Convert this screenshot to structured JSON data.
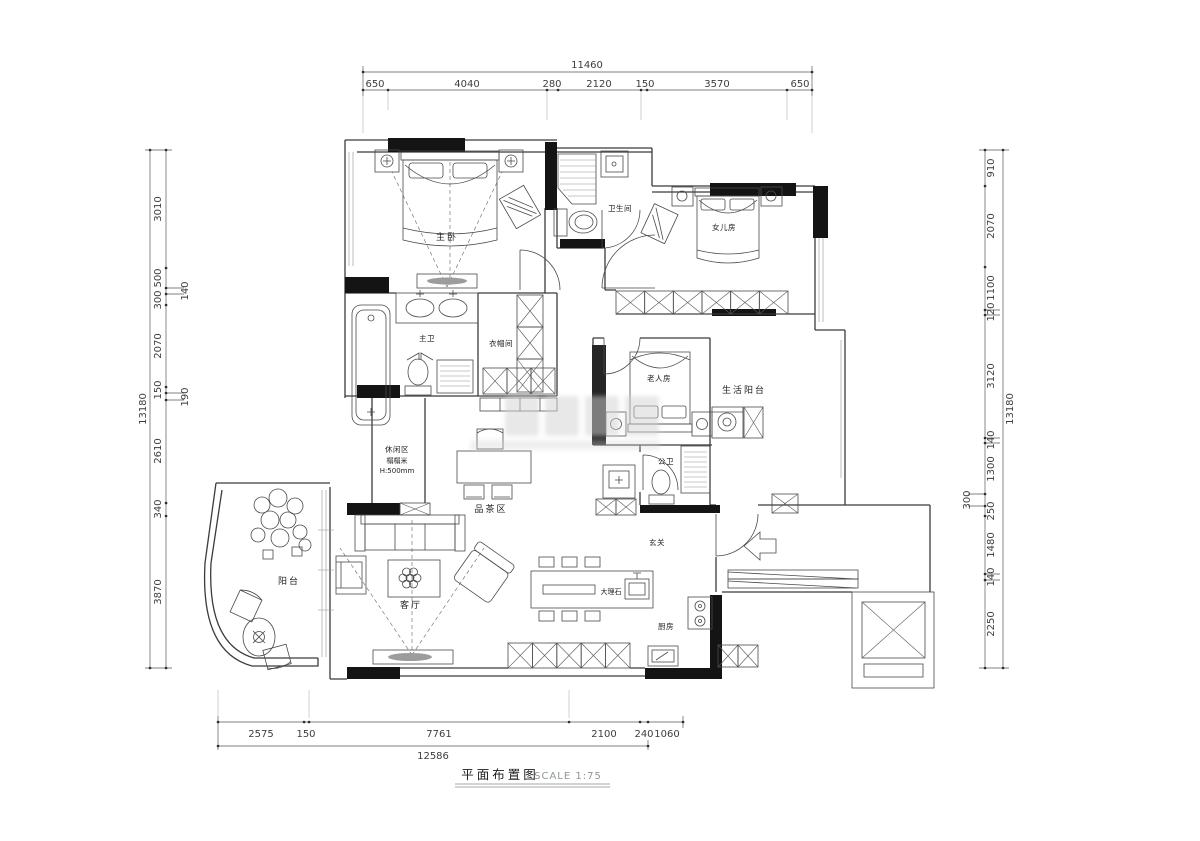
{
  "title": {
    "name": "平面布置图",
    "scale": "SCALE 1:75"
  },
  "rooms": {
    "master_bedroom": "主卧",
    "bathroom": "卫生间",
    "daughter_room": "女儿房",
    "master_bath": "主卫",
    "closet": "衣帽间",
    "elder_room": "老人房",
    "service_balcony": "生活阳台",
    "public_bath": "公卫",
    "leisure_area": "休闲区",
    "leisure_type": "榻榻米",
    "leisure_height": "H:500mm",
    "tea_area": "品茶区",
    "entrance": "玄关",
    "balcony": "阳台",
    "living_room": "客厅",
    "island_material": "大理石",
    "kitchen": "厨房"
  },
  "dimensions": {
    "top": {
      "total": "11460",
      "segments": [
        "650",
        "4040",
        "280",
        "2120",
        "150",
        "3570",
        "650"
      ]
    },
    "left": {
      "total": "13180",
      "segments": [
        "3010",
        "500",
        "140",
        "300",
        "2070",
        "150",
        "190",
        "2610",
        "340",
        "3870"
      ]
    },
    "right": {
      "total": "13180",
      "segments": [
        "910",
        "2070",
        "1100",
        "120",
        "3120",
        "140",
        "1300",
        "300",
        "250",
        "1480",
        "140",
        "2250"
      ]
    },
    "bottom": {
      "total": "12586",
      "segments": [
        "2575",
        "150",
        "7761",
        "2100",
        "240",
        "1060"
      ]
    }
  },
  "colors": {
    "wall": "#141414",
    "line": "#3b3b3b",
    "dim_text": "#3d3d3d",
    "scale_text": "#8d9797"
  }
}
